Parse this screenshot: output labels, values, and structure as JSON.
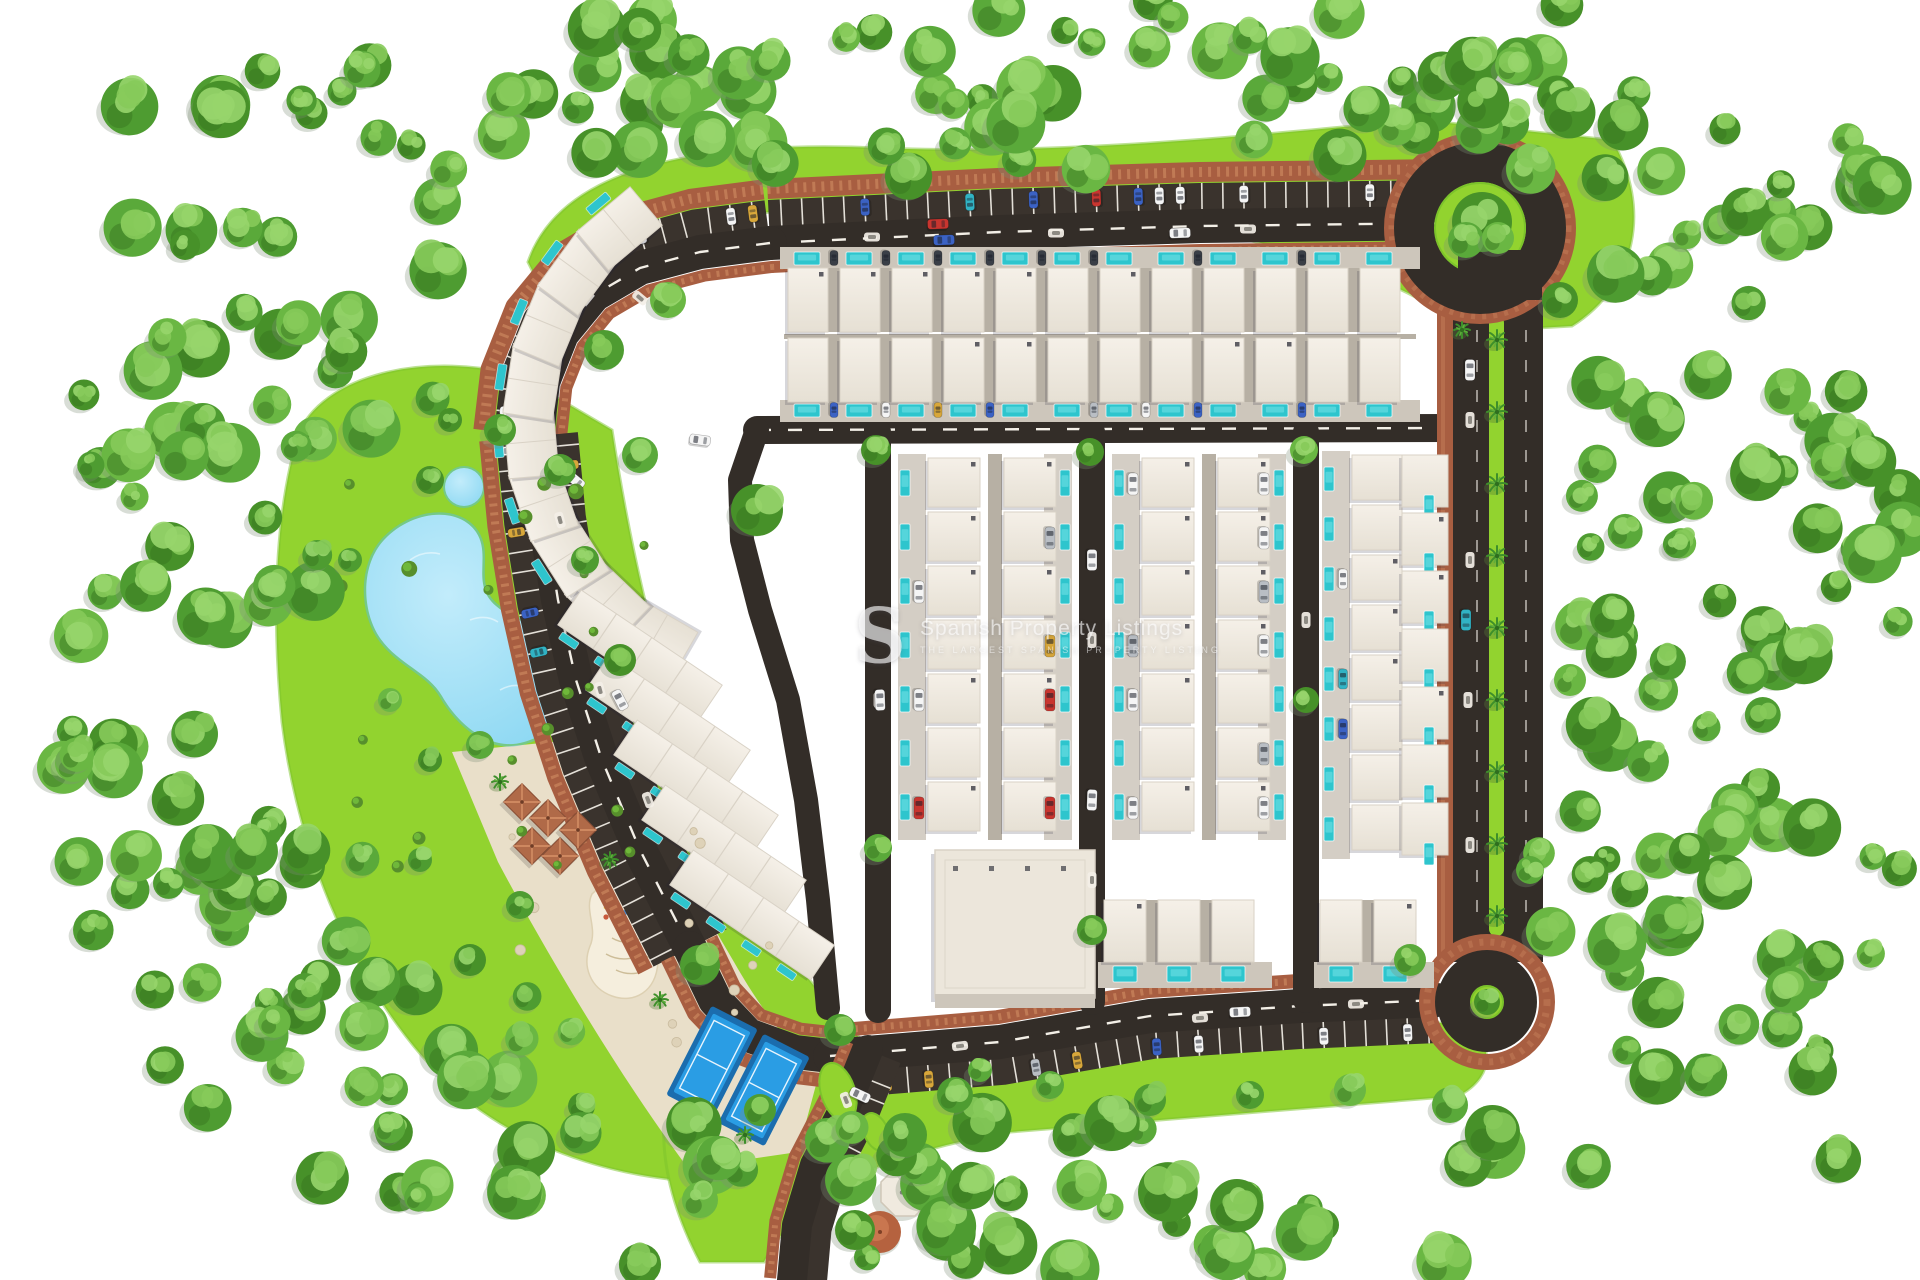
{
  "meta": {
    "title": "Aerial 3D master plan render of a gated villa community",
    "canvas_w": 1920,
    "canvas_h": 1280
  },
  "watermark": {
    "logo_letter": "S",
    "line1": "Spanish Property Listings",
    "line2": "THE LARGEST SPANISH PROPERTY LISTING",
    "x": 854,
    "y": 600,
    "color": "#ffffff",
    "opacity": 0.62
  },
  "palette": {
    "background": "#ffffff",
    "lawn": "#92d32f",
    "lawn_dark": "#7cc32b",
    "road": "#332d28",
    "stall_asphalt": "#3a332d",
    "line_white": "#f3efe7",
    "brick": "#a85e41",
    "brick_light": "#c07a55",
    "alley": "#b7b0a4",
    "walk": "#cdc6bb",
    "roof": "#f2ece3",
    "roof_shade": "#e4ddd0",
    "roof_edge": "#d9d2c6",
    "unit_shadow": "#23233a",
    "pool": "#2ec5cd",
    "pool_light": "#5fd8de",
    "lake": "#85d5f1",
    "lake_light": "#c2ecfb",
    "lake_edge": "#58bfe2",
    "sand": "#e9dfc9",
    "sand_light": "#f5eedd",
    "court_blue": "#2a9de4",
    "court_dark": "#1b6dae",
    "gazebo": "#b06a48",
    "gazebo_line": "#d79268",
    "dome": "#b5623f",
    "tree_greens": [
      "#4e9c31",
      "#5aa93a",
      "#6ab743",
      "#479129"
    ],
    "tree_light": [
      "#86ca5a",
      "#97d56b"
    ],
    "tree_dark": "#37761f",
    "palm_green": "#3e8f2b",
    "car_colors": [
      "#f5f5f5",
      "#f5f5f5",
      "#f5f5f5",
      "#c8352f",
      "#3b62c4",
      "#d8a73a",
      "#b9bec4",
      "#31b3c4"
    ]
  },
  "scene": {
    "seed": 42,
    "lawns": [
      {
        "name": "north-lawn",
        "path": "M528,262 C560,170 690,140 880,148 C1080,156 1280,132 1420,120 L1612,140 C1652,208 1636,286 1572,326 L1468,332 C1380,256 1180,212 930,206 C760,202 620,224 548,302 Z"
      },
      {
        "name": "west-park-lawn",
        "path": "M300,430 C330,372 430,352 520,376 L612,430 C632,560 664,706 724,834 C766,928 818,1000 880,1058 L842,1160 C726,1206 566,1176 472,1104 C380,1032 302,884 282,722 C270,598 278,498 300,430 Z"
      },
      {
        "name": "south-lawn",
        "path": "M688,1046 C800,1064 920,1064 1020,1056 L1452,1022 C1496,1034 1498,1076 1458,1096 L1010,1132 C906,1150 806,1180 764,1262 L700,1262 C656,1178 652,1102 688,1046 Z"
      }
    ],
    "sand_plaza": {
      "name": "sand-plaza",
      "path": "M452,752 L592,738 C642,800 688,884 734,962 C766,1018 792,1048 820,1070 L798,1152 L688,1168 C622,1080 548,956 498,862 Z"
    },
    "playground": {
      "name": "playground-sand",
      "path": "M612,876 C644,866 670,880 674,908 C678,932 660,940 658,962 C656,992 634,1004 612,996 C590,988 582,966 590,946 C598,928 584,910 592,894 Z",
      "equipment": {
        "x": 612,
        "y": 908
      }
    },
    "lake": {
      "name": "lagoon",
      "path": "M384,540 C412,510 458,506 476,532 C492,556 470,584 496,606 C524,630 556,622 566,656 C580,700 560,732 524,742 C490,752 458,724 442,696 C428,672 398,664 380,638 C362,612 360,566 384,540 Z",
      "pond": {
        "cx": 464,
        "cy": 487,
        "r": 19
      }
    },
    "roads": [
      {
        "name": "top-road",
        "pts": [
          [
            770,
            243
          ],
          [
            1000,
            232
          ],
          [
            1200,
            226
          ],
          [
            1448,
            223
          ]
        ],
        "w": 34,
        "dash": true,
        "stalls": [
          {
            "side": -1,
            "depth": 26,
            "spacing": 21,
            "t1": 0.96
          }
        ],
        "bricks": [
          {
            "side": -1,
            "gap": 27,
            "bw": 20
          },
          {
            "side": 1,
            "gap": 1,
            "bw": 12
          }
        ]
      },
      {
        "name": "northwest-arc",
        "pts": [
          [
            770,
            243
          ],
          [
            700,
            252
          ],
          [
            640,
            268
          ],
          [
            594,
            295
          ],
          [
            562,
            334
          ],
          [
            543,
            382
          ],
          [
            537,
            436
          ]
        ],
        "w": 34,
        "dash": true,
        "stalls": [
          {
            "side": 1,
            "depth": 26,
            "spacing": 22
          }
        ],
        "bricks": [
          {
            "side": 1,
            "gap": 27,
            "bw": 20
          },
          {
            "side": -1,
            "gap": 1,
            "bw": 12
          }
        ]
      },
      {
        "name": "west-road",
        "pts": [
          [
            537,
            436
          ],
          [
            545,
            520
          ],
          [
            558,
            600
          ],
          [
            576,
            680
          ],
          [
            602,
            760
          ],
          [
            640,
            850
          ],
          [
            690,
            948
          ]
        ],
        "w": 34,
        "dash": true,
        "stalls": [
          {
            "side": 1,
            "depth": 24,
            "spacing": 20
          },
          {
            "side": -1,
            "depth": 24,
            "spacing": 20,
            "t1": 0.4
          }
        ],
        "bricks": [
          {
            "side": 1,
            "gap": 25,
            "bw": 16
          },
          {
            "side": -1,
            "gap": 1,
            "bw": 12
          }
        ]
      },
      {
        "name": "southwest-curve",
        "pts": [
          [
            690,
            948
          ],
          [
            715,
            1000
          ],
          [
            748,
            1035
          ],
          [
            795,
            1052
          ],
          [
            830,
            1056
          ]
        ],
        "w": 34,
        "bricks": [
          {
            "side": 1,
            "gap": 1,
            "bw": 14
          },
          {
            "side": -1,
            "gap": 1,
            "bw": 12
          }
        ]
      },
      {
        "name": "south-road",
        "pts": [
          [
            830,
            1056
          ],
          [
            1000,
            1042
          ],
          [
            1150,
            1016
          ],
          [
            1300,
            1006
          ],
          [
            1437,
            1000
          ]
        ],
        "w": 34,
        "dash": true,
        "stalls": [
          {
            "side": 1,
            "depth": 26,
            "spacing": 21,
            "t0": 0.08
          }
        ],
        "bricks": [
          {
            "side": -1,
            "gap": 1,
            "bw": 14
          }
        ]
      },
      {
        "name": "entrance-road",
        "pts": [
          [
            868,
            1050
          ],
          [
            846,
            1105
          ],
          [
            815,
            1165
          ],
          [
            797,
            1225
          ],
          [
            792,
            1280
          ]
        ],
        "w": 30,
        "stalls": [
          {
            "side": -1,
            "depth": 20,
            "spacing": 17,
            "t0": 0.05,
            "t1": 0.5
          }
        ],
        "bricks": [
          {
            "side": 1,
            "gap": 1,
            "bw": 12
          }
        ]
      },
      {
        "name": "street-a",
        "pts": [
          [
            757,
            430
          ],
          [
            1452,
            428
          ]
        ],
        "w": 28,
        "dash": true
      },
      {
        "name": "street-b",
        "pts": [
          [
            757,
            430
          ],
          [
            740,
            480
          ],
          [
            742,
            540
          ],
          [
            760,
            610
          ],
          [
            788,
            700
          ],
          [
            806,
            800
          ],
          [
            818,
            900
          ],
          [
            828,
            1008
          ]
        ],
        "w": 24
      },
      {
        "name": "street-v1",
        "pts": [
          [
            878,
            432
          ],
          [
            878,
            1010
          ]
        ],
        "w": 26
      },
      {
        "name": "street-v2",
        "pts": [
          [
            1092,
            432
          ],
          [
            1092,
            1002
          ]
        ],
        "w": 26
      },
      {
        "name": "street-v3",
        "pts": [
          [
            1306,
            432
          ],
          [
            1306,
            1000
          ]
        ],
        "w": 26
      }
    ],
    "right_road": {
      "name": "east-avenue",
      "brick": [
        1437,
        296,
        16,
        664
      ],
      "asphalt": [
        1453,
        290,
        90,
        672
      ],
      "median": [
        1489,
        316,
        15,
        620
      ],
      "dash_x": [
        1477,
        1526
      ],
      "dash_y": [
        330,
        930
      ]
    },
    "roundabouts": [
      {
        "name": "north-roundabout",
        "cx": 1480,
        "cy": 228,
        "r_brick": 88,
        "r_road_mid": 66,
        "road_w": 40,
        "r_green": 45,
        "trees": 3
      },
      {
        "name": "south-roundabout",
        "cx": 1487,
        "cy": 1002,
        "r_brick": 60,
        "r_road_mid": 0,
        "r_fill": 50,
        "r_green": 16,
        "trees": 1
      }
    ],
    "housing": {
      "top_rows": {
        "x0": 788,
        "uw": 52,
        "n": 12,
        "rowA": {
          "y": 268,
          "depth": 64,
          "pool_y": 252
        },
        "rowB": {
          "y": 338,
          "depth": 64,
          "pool_y": 404
        },
        "alley_y": 334
      },
      "strip_cfg": {
        "y0": 458,
        "uh": 54,
        "n": 7
      },
      "strips": [
        {
          "x0": 898
        },
        {
          "x0": 1112
        }
      ],
      "right_inner": {
        "x": 1324,
        "y0": 455,
        "uh": 50,
        "n": 8
      },
      "right_outer": {
        "x": 1402,
        "y0": 455,
        "uh": 58,
        "n": 7
      },
      "bottom_rows": [
        {
          "x0": 1104,
          "uw": 54,
          "n": 3,
          "y": 900,
          "depth": 62,
          "pool_y": 966
        },
        {
          "x0": 1320,
          "uw": 54,
          "n": 2,
          "y": 900,
          "depth": 62,
          "pool_y": 966
        }
      ],
      "fan": {
        "cx": 780,
        "cy": 420,
        "r": 250,
        "a0": 120,
        "a1": 230,
        "n": 9,
        "w": 70,
        "h": 50
      },
      "diag_blocks": {
        "angle": 34,
        "w": 170,
        "h": 42,
        "pools_per": 4,
        "centers": [
          [
            640,
            655
          ],
          [
            668,
            720
          ],
          [
            696,
            785
          ],
          [
            724,
            850
          ],
          [
            752,
            915
          ]
        ]
      }
    },
    "clubhouse": {
      "name": "clubhouse",
      "x": 935,
      "y": 850,
      "w": 160,
      "h": 148
    },
    "courts": [
      {
        "name": "padel-court",
        "cx": 712,
        "cy": 1062,
        "rot": 27
      },
      {
        "name": "padel-court",
        "cx": 764,
        "cy": 1090,
        "rot": 27
      }
    ],
    "gazebos": [
      [
        522,
        802
      ],
      [
        548,
        818
      ],
      [
        532,
        846
      ],
      [
        560,
        856
      ],
      [
        578,
        830
      ]
    ],
    "pavilion": {
      "name": "garden-pavilion",
      "cx": 905,
      "cy": 1192,
      "dome_cx": 880,
      "dome_cy": 1232
    },
    "palms_median": {
      "x": 1497,
      "y0": 340,
      "dy": 72,
      "n": 9
    },
    "entrance_islands": [
      {
        "cx": 838,
        "cy": 1092,
        "rx": 17,
        "ry": 30,
        "rot": -18
      },
      {
        "cx": 876,
        "cy": 1132,
        "rx": 12,
        "ry": 20,
        "rot": -24
      }
    ],
    "glyphs": [
      [
        872,
        237,
        0
      ],
      [
        1056,
        233,
        0
      ],
      [
        1248,
        229,
        0
      ],
      [
        640,
        298,
        40
      ],
      [
        560,
        520,
        75
      ],
      [
        600,
        690,
        75
      ],
      [
        648,
        800,
        70
      ],
      [
        960,
        1046,
        -7
      ],
      [
        1200,
        1018,
        -4
      ],
      [
        1356,
        1004,
        -2
      ],
      [
        1470,
        420,
        90
      ],
      [
        1470,
        560,
        90
      ],
      [
        1468,
        700,
        90
      ],
      [
        1470,
        845,
        90
      ],
      [
        846,
        1100,
        70
      ],
      [
        1092,
        640,
        90
      ],
      [
        878,
        700,
        90
      ],
      [
        1306,
        620,
        90
      ],
      [
        1092,
        880,
        90
      ]
    ],
    "cars": [
      {
        "x": 938,
        "y": 224,
        "rot": -2,
        "color": "#c8352f"
      },
      {
        "x": 944,
        "y": 240,
        "rot": -2,
        "color": "#3b62c4"
      },
      {
        "x": 1180,
        "y": 233,
        "rot": -2,
        "color": "#f5f5f5"
      },
      {
        "x": 1470,
        "y": 370,
        "rot": 90,
        "color": "#f5f5f5"
      },
      {
        "x": 1466,
        "y": 620,
        "rot": 90,
        "color": "#31b3c4"
      },
      {
        "x": 880,
        "y": 700,
        "rot": 88,
        "color": "#f5f5f5"
      },
      {
        "x": 1092,
        "y": 560,
        "rot": 90,
        "color": "#f5f5f5"
      },
      {
        "x": 1092,
        "y": 800,
        "rot": 92,
        "color": "#f5f5f5"
      },
      {
        "x": 1240,
        "y": 1012,
        "rot": -3,
        "color": "#f5f5f5"
      },
      {
        "x": 620,
        "y": 700,
        "rot": 62,
        "color": "#f5f5f5"
      },
      {
        "x": 575,
        "y": 480,
        "rot": 40,
        "color": "#f5f5f5"
      },
      {
        "x": 860,
        "y": 1095,
        "rot": 25,
        "color": "#f5f5f5"
      },
      {
        "x": 700,
        "y": 440,
        "rot": 8,
        "color": "#f5f5f5"
      }
    ],
    "trees": [
      [
        757,
        510,
        26
      ],
      [
        876,
        450,
        15
      ],
      [
        1090,
        452,
        14
      ],
      [
        1304,
        450,
        14
      ],
      [
        1306,
        700,
        13
      ],
      [
        878,
        848,
        14
      ],
      [
        1092,
        930,
        15
      ],
      [
        700,
        965,
        20
      ],
      [
        640,
        455,
        18
      ],
      [
        604,
        350,
        20
      ],
      [
        668,
        300,
        18
      ],
      [
        560,
        470,
        16
      ],
      [
        585,
        560,
        14
      ],
      [
        620,
        660,
        16
      ],
      [
        840,
        1030,
        16
      ],
      [
        905,
        1135,
        22
      ],
      [
        955,
        1095,
        18
      ],
      [
        855,
        1230,
        20
      ],
      [
        700,
        1200,
        18
      ],
      [
        760,
        1110,
        16
      ],
      [
        1410,
        960,
        16
      ],
      [
        1450,
        1105,
        18
      ],
      [
        1350,
        1090,
        16
      ],
      [
        1250,
        1095,
        14
      ],
      [
        1150,
        1100,
        16
      ],
      [
        1050,
        1085,
        14
      ],
      [
        980,
        1070,
        12
      ],
      [
        480,
        745,
        14
      ],
      [
        430,
        760,
        12
      ],
      [
        520,
        905,
        14
      ],
      [
        470,
        960,
        16
      ],
      [
        420,
        860,
        12
      ],
      [
        390,
        700,
        12
      ],
      [
        350,
        560,
        12
      ],
      [
        430,
        480,
        14
      ],
      [
        500,
        430,
        16
      ],
      [
        450,
        420,
        12
      ],
      [
        1560,
        300,
        18
      ],
      [
        1570,
        680,
        16
      ],
      [
        1530,
        870,
        14
      ]
    ],
    "forest_bands": [
      {
        "x": 430,
        "y": 0,
        "w": 1140,
        "h": 148,
        "n": 46
      },
      {
        "x": 120,
        "y": 60,
        "w": 340,
        "h": 420,
        "n": 34
      },
      {
        "x": 60,
        "y": 380,
        "w": 260,
        "h": 560,
        "n": 40
      },
      {
        "x": 1590,
        "y": 80,
        "w": 320,
        "h": 420,
        "n": 36
      },
      {
        "x": 1560,
        "y": 420,
        "w": 350,
        "h": 430,
        "n": 38
      },
      {
        "x": 1500,
        "y": 840,
        "w": 410,
        "h": 330,
        "n": 30
      },
      {
        "x": 620,
        "y": 1120,
        "w": 880,
        "h": 155,
        "n": 40
      },
      {
        "x": 300,
        "y": 980,
        "w": 340,
        "h": 220,
        "n": 24
      },
      {
        "x": 1260,
        "y": 55,
        "w": 330,
        "h": 140,
        "n": 14
      },
      {
        "x": 150,
        "y": 850,
        "w": 260,
        "h": 260,
        "n": 18
      },
      {
        "x": 560,
        "y": 118,
        "w": 800,
        "h": 60,
        "n": 10
      }
    ],
    "bushes": {
      "x": 330,
      "y": 470,
      "w": 330,
      "h": 430,
      "n": 22
    },
    "rocks": {
      "x": 500,
      "y": 780,
      "w": 280,
      "h": 340,
      "n": 12
    }
  }
}
